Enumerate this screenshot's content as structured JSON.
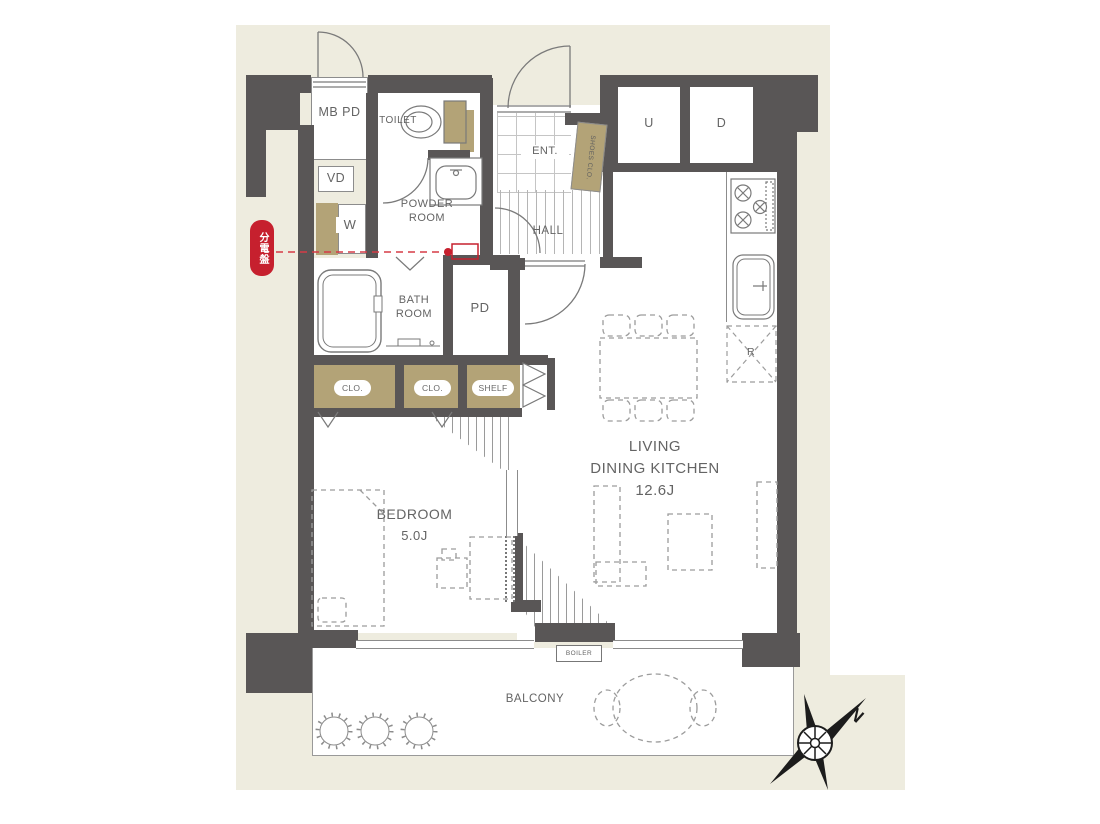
{
  "title": "1LDK apartment floor plan",
  "colors": {
    "background_beige": "#eeecdf",
    "wall_gray": "#595656",
    "closet_tan": "#b3a377",
    "accent_red": "#c6202e",
    "line_gray": "#8c8c8c",
    "text_gray": "#646464"
  },
  "labels": {
    "mb_pd": "MB PD",
    "vd": "VD",
    "toilet": "TOILET",
    "powder1": "POWDER",
    "powder2": "ROOM",
    "ent": "ENT.",
    "shoes_clo": "SHOES CLO.",
    "hall": "HALL",
    "washer": "W",
    "bath1": "BATH",
    "bath2": "ROOM",
    "pipe_duct": "PD",
    "clo1": "CLO.",
    "clo2": "CLO.",
    "shelf": "SHELF",
    "stairs_up": "U",
    "stairs_down": "D",
    "fridge": "R",
    "ldk1": "LIVING",
    "ldk2": "DINING KITCHEN",
    "ldk_area": "12.6J",
    "bedroom": "BEDROOM",
    "bedroom_area": "5.0J",
    "balcony": "BALCONY",
    "boiler": "BOILER",
    "distribution_board": "分電盤",
    "north": "N"
  }
}
